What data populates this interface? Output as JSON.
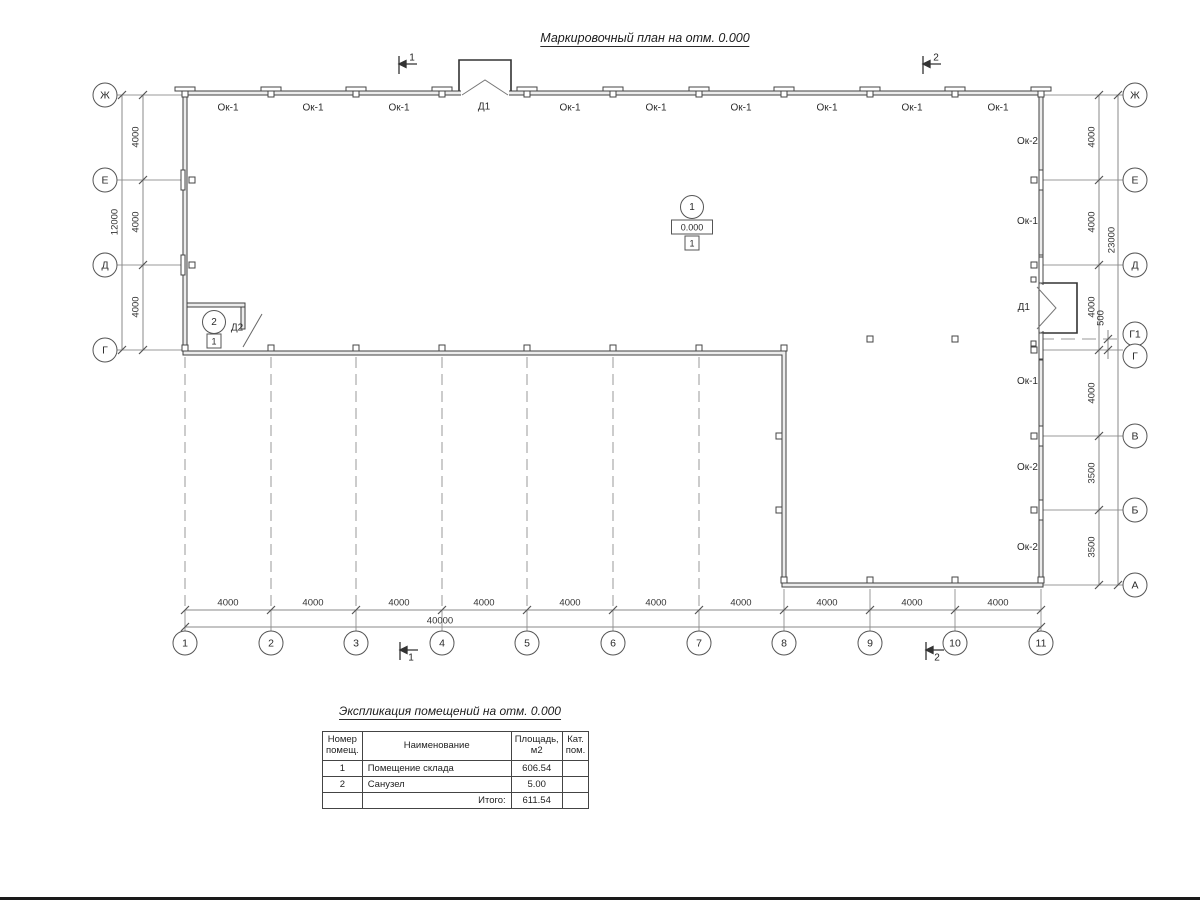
{
  "page": {
    "title": "Маркировочный план на отм. 0.000"
  },
  "plan": {
    "axes_left": [
      "Ж",
      "Е",
      "Д",
      "Г"
    ],
    "axes_right": [
      "Ж",
      "Е",
      "Д",
      "Г1",
      "Г",
      "В",
      "Б",
      "А"
    ],
    "columns": [
      "1",
      "2",
      "3",
      "4",
      "5",
      "6",
      "7",
      "8",
      "9",
      "10",
      "11"
    ],
    "top_labels": [
      "Ок-1",
      "Ок-1",
      "Ок-1",
      "Д1",
      "Ок-1",
      "Ок-1",
      "Ок-1",
      "Ок-1",
      "Ок-1",
      "Ок-1"
    ],
    "right_labels": [
      "Ок-2",
      "Ок-1",
      "Д1",
      "Ок-1",
      "Ок-2",
      "Ок-2"
    ],
    "dims_left": [
      "4000",
      "4000",
      "4000"
    ],
    "dim_left_total": "12000",
    "dims_right": [
      "4000",
      "4000",
      "4000",
      "4000",
      "3500",
      "3500"
    ],
    "dim_right_sub": "500",
    "dim_right_total": "23000",
    "dims_bottom": [
      "4000",
      "4000",
      "4000",
      "4000",
      "4000",
      "4000",
      "4000",
      "4000",
      "4000",
      "4000"
    ],
    "dim_bottom_total": "40000",
    "sections": {
      "s1": "1",
      "s2": "2"
    },
    "rooms": {
      "room1": {
        "number": "1",
        "elevation": "0.000",
        "floor": "1"
      },
      "room2": {
        "number": "2",
        "floor": "1",
        "door": "Д2"
      }
    }
  },
  "schedule": {
    "title": "Экспликация помещений на отм. 0.000",
    "headers": {
      "num": "Номер\nпомещ.",
      "name": "Наименование",
      "area": "Площадь,\nм2",
      "cat": "Кат.\nпом."
    },
    "rows": [
      {
        "num": "1",
        "name": "Помещение склада",
        "area": "606.54",
        "cat": ""
      },
      {
        "num": "2",
        "name": "Санузел",
        "area": "5.00",
        "cat": ""
      }
    ],
    "total_label": "Итого:",
    "total": "611.54"
  }
}
